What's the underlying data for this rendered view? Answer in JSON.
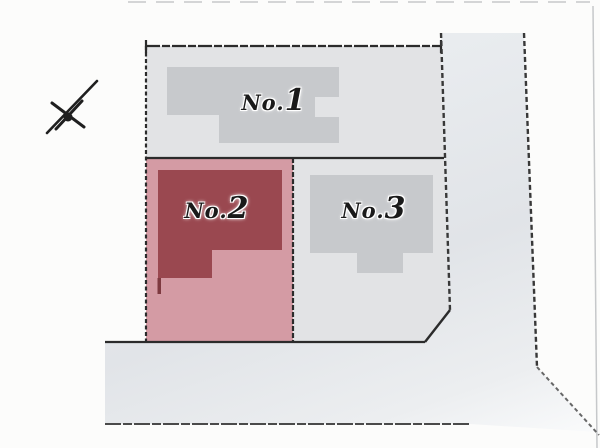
{
  "diagram": {
    "kind": "residential-lot-site-plan"
  },
  "lots": [
    {
      "prefix": "No.",
      "number": "1",
      "highlighted": false
    },
    {
      "prefix": "No.",
      "number": "2",
      "highlighted": true
    },
    {
      "prefix": "No.",
      "number": "3",
      "highlighted": false
    }
  ],
  "colors": {
    "background": "#fcfcfb",
    "lot_gray": "#e2e3e5",
    "building_gray": "#c7c9cc",
    "lot_pink": "#d49ba4",
    "building_red": "#9a4850",
    "building_red_dark": "#7e3a40",
    "boundary_line": "#2b2b2b",
    "road_edge_line": "#383838",
    "road_bottom_line": "#4a4a4a",
    "faint_line": "#c6c8ca",
    "compass_color": "#1f1f1f"
  }
}
